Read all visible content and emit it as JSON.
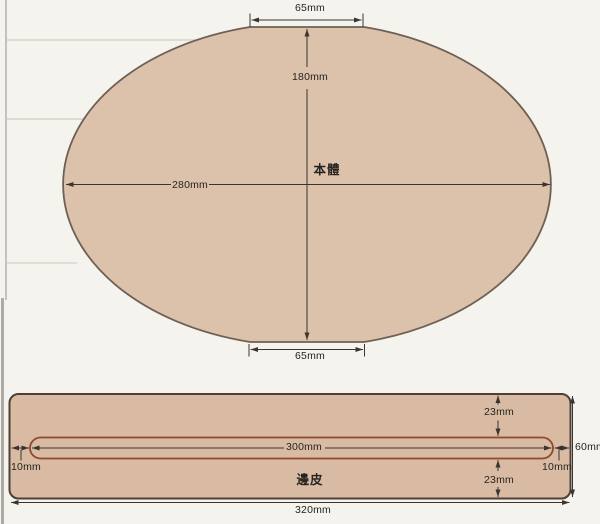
{
  "colors": {
    "background": "#f5f3ee",
    "leather_fill_body": "#dcc1ab",
    "leather_fill_strip": "#d8bba2",
    "body_outline": "#6f6055",
    "strip_outline": "#4e4037",
    "slot_outline": "#8e4a2c",
    "dimension_line": "#3a3530",
    "label_text": "#262420"
  },
  "main_body": {
    "label": "本體",
    "top_width": "65mm",
    "height": "180mm",
    "width": "280mm",
    "bottom_width": "65mm"
  },
  "edge_strip": {
    "label": "邊皮",
    "slot_length": "300mm",
    "left_offset": "10mm",
    "right_offset": "10mm",
    "top_offset": "23mm",
    "bottom_offset": "23mm",
    "height": "60mm",
    "total_width": "320mm"
  }
}
